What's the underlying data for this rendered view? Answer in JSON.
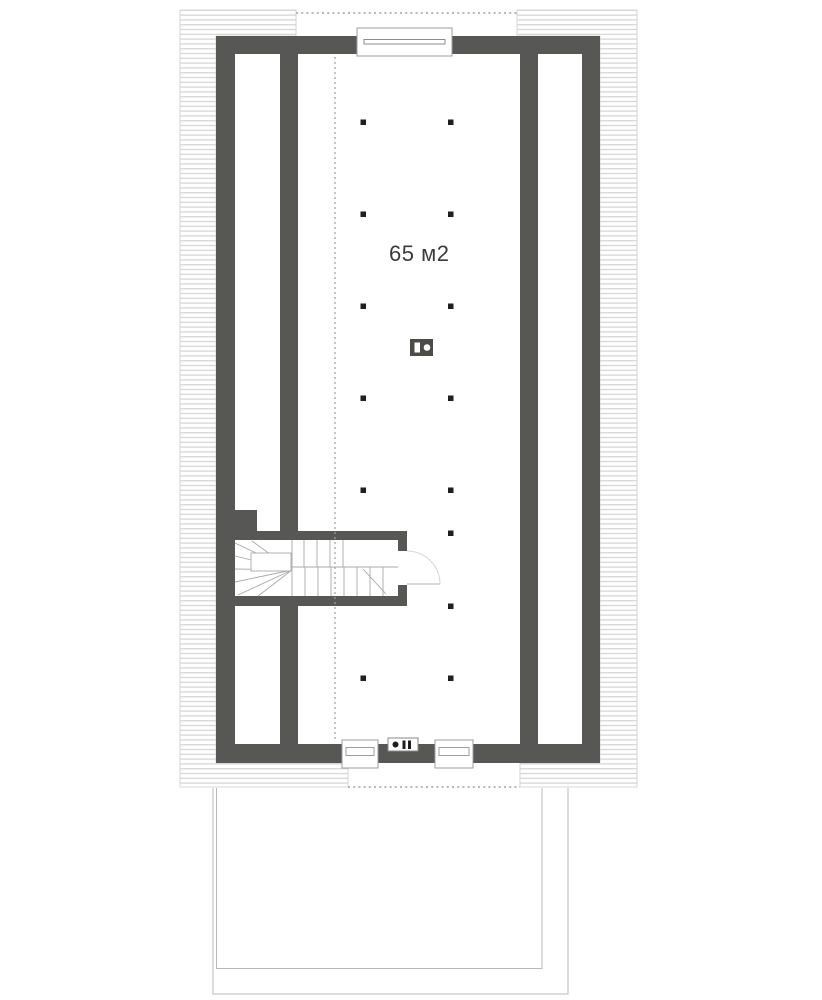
{
  "plan": {
    "area_label": "65 м2",
    "colors": {
      "background": "#ffffff",
      "wall": "#575755",
      "hatch": "#d9d9d9",
      "thin_line": "#a9a9a9",
      "dotted_line": "#9f9f9f",
      "terrace_line": "#b8b8b8",
      "door_arc": "#d6d6d6",
      "dot": "#1f1f1f",
      "text": "#3b3b3b"
    }
  }
}
